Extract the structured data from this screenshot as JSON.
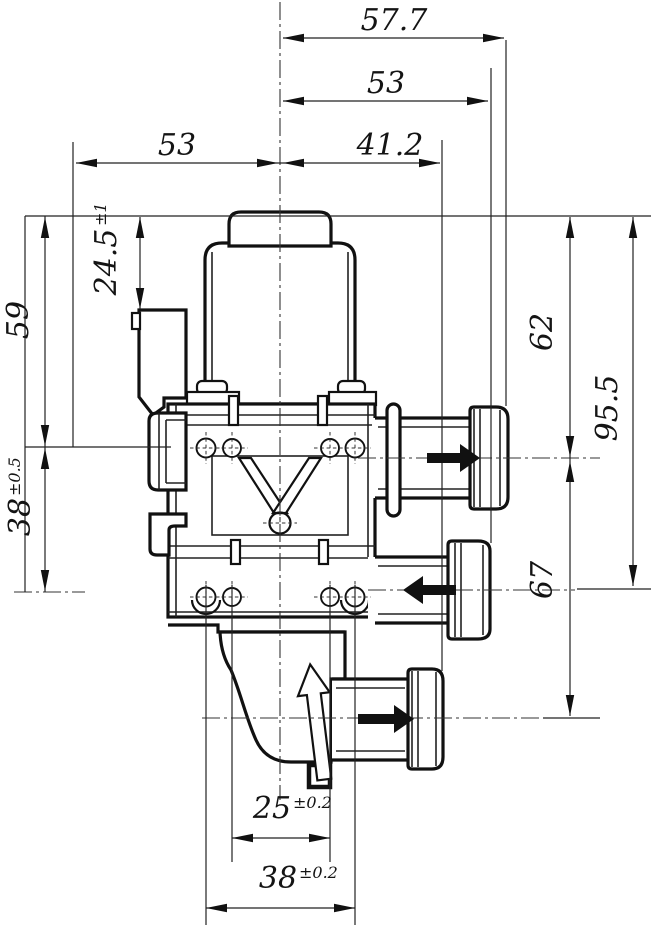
{
  "drawing": {
    "background": "#ffffff",
    "line_color": "#141414",
    "dimensions": {
      "top_overall": "57.7",
      "top_to_mid_port": "53",
      "left_to_center": "53",
      "center_to_bottom_port": "41.2",
      "connector_top": {
        "value": "24.5",
        "tolerance": "±1"
      },
      "left_upper": "59",
      "left_lower": {
        "value": "38",
        "tolerance": "±0.5"
      },
      "right_upper_port": "62",
      "right_mid_port": "95.5",
      "port_spacing": "67",
      "bottom_inner_holes": {
        "value": "25",
        "tolerance": "±0.2"
      },
      "bottom_outer_holes": {
        "value": "38",
        "tolerance": "±0.2"
      }
    },
    "flow_arrows": {
      "upper_port": "right",
      "middle_port": "left",
      "bottom_port": "right",
      "internal": "up"
    }
  }
}
